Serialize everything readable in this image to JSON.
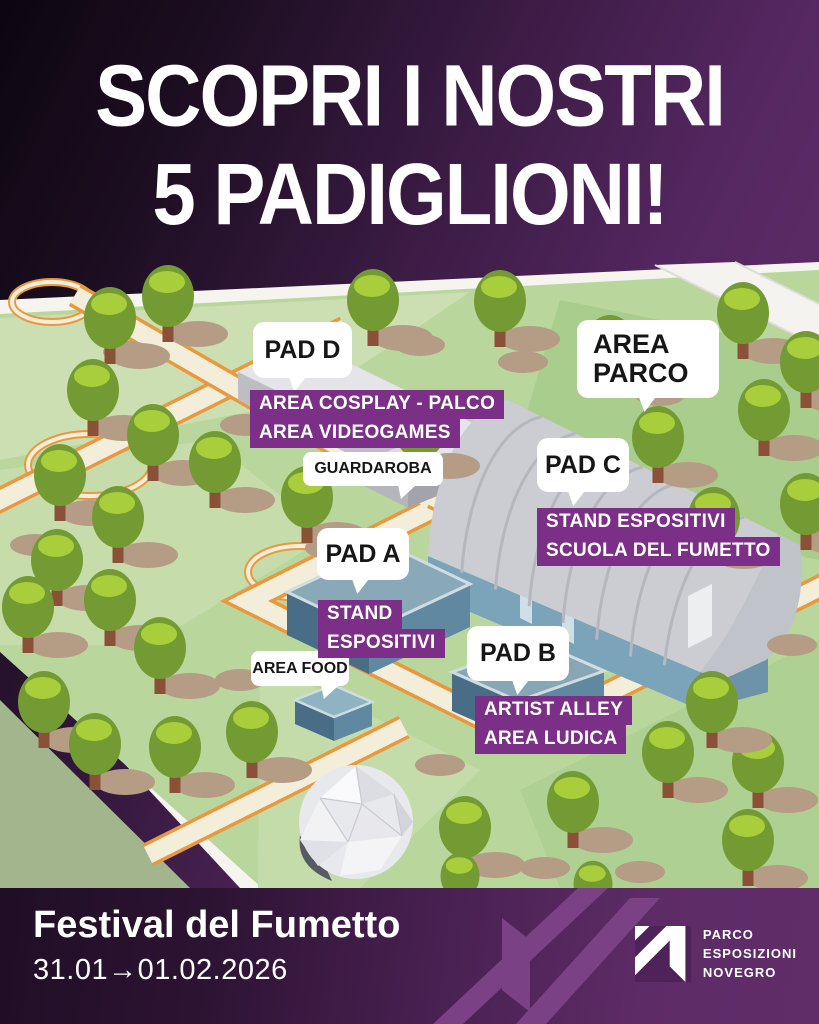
{
  "header": {
    "line1": "SCOPRI I NOSTRI",
    "line2": "5 PADIGLIONI!"
  },
  "map": {
    "bubbles": {
      "pad_d": "PAD D",
      "area_parco_line1": "AREA",
      "area_parco_line2": "PARCO",
      "guardaroba": "GUARDAROBA",
      "pad_c": "PAD C",
      "pad_a": "PAD A",
      "area_food": "AREA FOOD",
      "pad_b": "PAD B"
    },
    "chips": {
      "pad_d_line1": "AREA COSPLAY - PALCO",
      "pad_d_line2": "AREA VIDEOGAMES",
      "pad_c_line1": "STAND ESPOSITIVI",
      "pad_c_line2": "SCUOLA DEL FUMETTO",
      "pad_a_line1": "STAND",
      "pad_a_line2": "ESPOSITIVI",
      "pad_b_line1": "ARTIST ALLEY",
      "pad_b_line2": "AREA LUDICA"
    }
  },
  "footer": {
    "title": "Festival del Fumetto",
    "dates": "31.01→01.02.2026",
    "logo_line1": "PARCO",
    "logo_line2": "ESPOSIZIONI",
    "logo_line3": "NOVEGRO"
  },
  "colors": {
    "chip_purple": "#7b2f87",
    "bar_purple": "#5d2b66",
    "grass": "#b9d69c",
    "path_orange": "#e8993f",
    "path_cream": "#f3eeda"
  }
}
